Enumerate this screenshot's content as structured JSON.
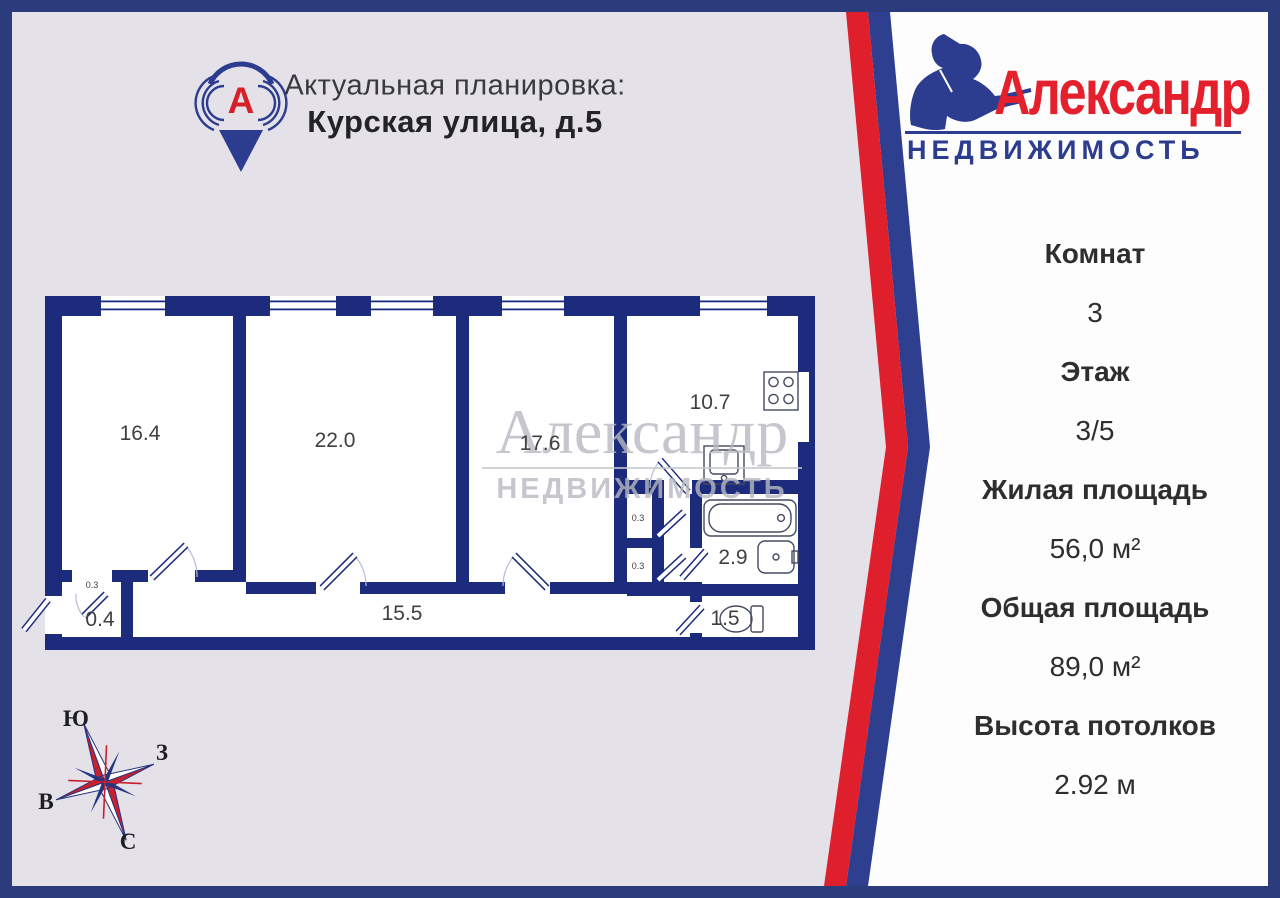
{
  "header": {
    "line1": "Актуальная планировка:",
    "line2": "Курская улица, д.5"
  },
  "pin": {
    "letter": "А"
  },
  "logo": {
    "name": "Александр",
    "subtitle": "НЕДВИЖИМОСТЬ"
  },
  "watermark": {
    "line1": "Александр",
    "line2": "НЕДВИЖИМОСТЬ"
  },
  "panel": {
    "rows": [
      {
        "label": "Комнат",
        "value": "3"
      },
      {
        "label": "Этаж",
        "value": "3/5"
      },
      {
        "label": "Жилая площадь",
        "value": "56,0 м²"
      },
      {
        "label": "Общая площадь",
        "value": "89,0 м²"
      },
      {
        "label": "Высота потолков",
        "value": "2.92 м"
      }
    ]
  },
  "plan": {
    "rooms": [
      "16.4",
      "22.0",
      "17.6",
      "10.7",
      "15.5",
      "0.4",
      "2.9",
      "1.5",
      "0.3",
      "0.3",
      "0.3"
    ]
  },
  "compass": {
    "south": "Ю",
    "west": "З",
    "east": "В",
    "north": "С"
  },
  "colors": {
    "frame": "#2c3b7c",
    "wall": "#1d2b7d",
    "stripe_red": "#e01f2d",
    "stripe_blue": "#2e3f8f",
    "logo_red": "#e3202b",
    "logo_blue": "#2c3c8e",
    "background": "#e4e1e8",
    "panel_bg": "#fdfdfe"
  }
}
